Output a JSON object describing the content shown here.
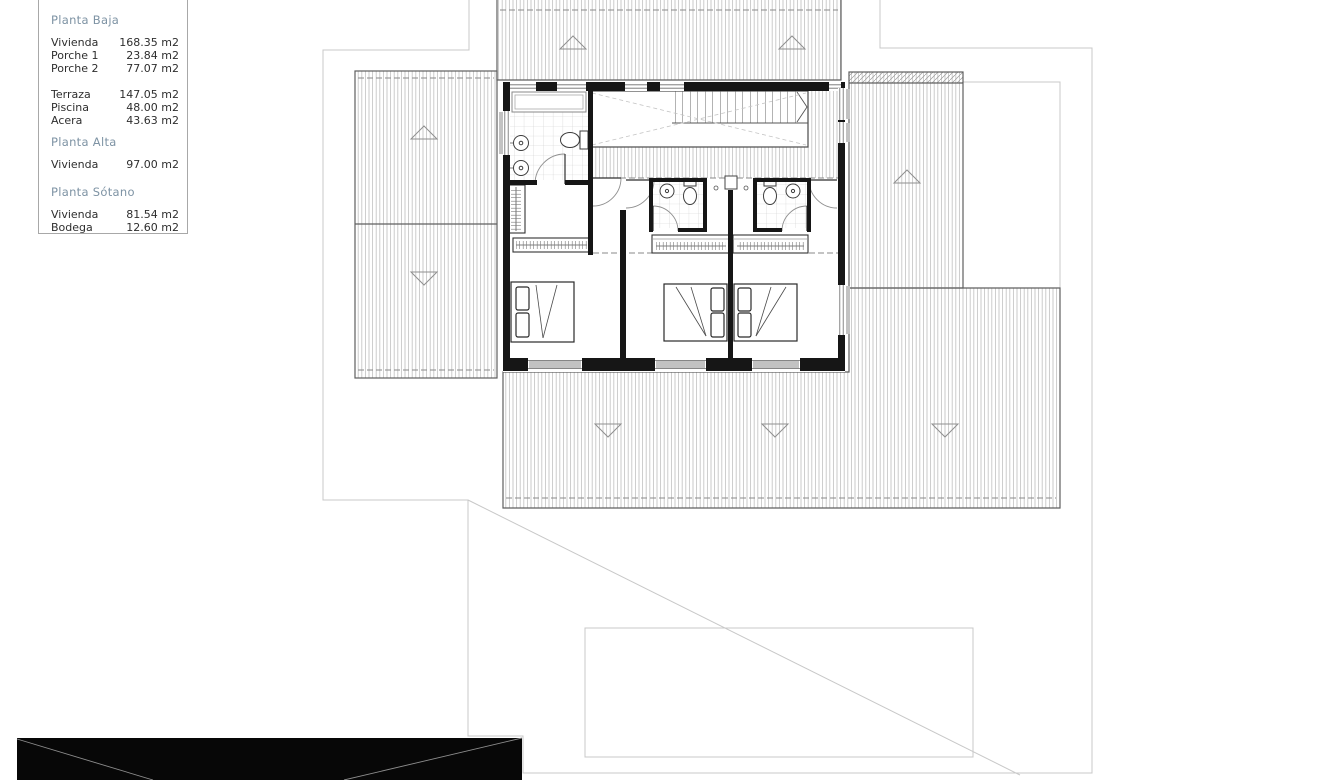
{
  "legend": {
    "sections": [
      {
        "title": "Planta Baja",
        "groups": [
          [
            {
              "label": "Vivienda",
              "value": "168.35 m2"
            },
            {
              "label": "Porche 1",
              "value": "23.84 m2"
            },
            {
              "label": "Porche 2",
              "value": "77.07 m2"
            }
          ],
          [
            {
              "label": "Terraza",
              "value": "147.05 m2"
            },
            {
              "label": "Piscina",
              "value": "48.00 m2"
            },
            {
              "label": "Acera",
              "value": "43.63 m2"
            }
          ]
        ]
      },
      {
        "title": "Planta Alta",
        "groups": [
          [
            {
              "label": "Vivienda",
              "value": "97.00 m2"
            }
          ]
        ]
      },
      {
        "title": "Planta Sótano",
        "groups": [
          [
            {
              "label": "Vivienda",
              "value": "81.54 m2"
            },
            {
              "label": "Bodega",
              "value": "12.60 m2"
            }
          ]
        ]
      }
    ]
  },
  "colors": {
    "heading": "#7e93a4",
    "text": "#2e2e2e",
    "wall": "#161616",
    "roofline": "#5f5f5f",
    "hatch": "#b0b0b0",
    "boundary": "#c8c8c8",
    "dash": "#8a8a8a",
    "sill": "#c2c2c2",
    "photo": "#070707",
    "fixture": "#3d3d3d"
  }
}
